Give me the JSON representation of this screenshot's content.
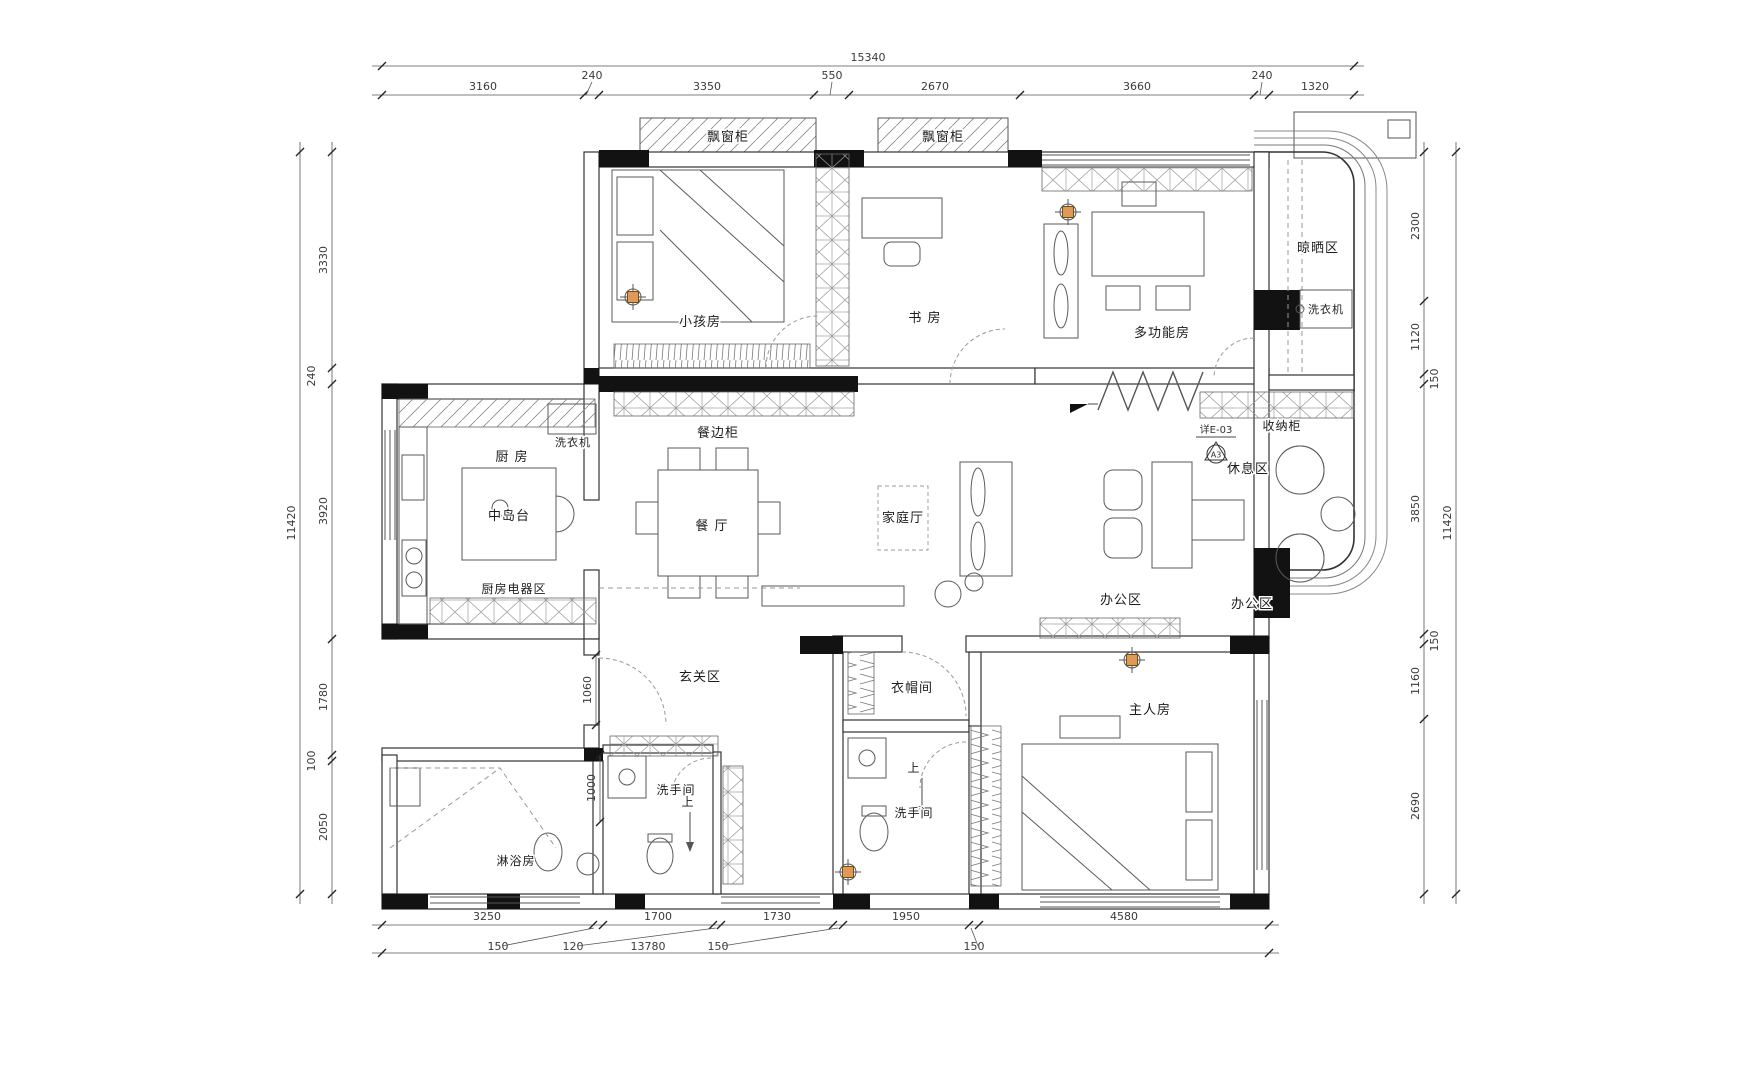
{
  "meta": {
    "drawing_type": "residential floor plan"
  },
  "rooms": {
    "bay_cabinet_1": "飘窗柜",
    "bay_cabinet_2": "飘窗柜",
    "kids_room": "小孩房",
    "study": "书 房",
    "multi_room": "多功能房",
    "drying_area": "晾晒区",
    "washer_balcony": "洗衣机",
    "storage_cabinet": "收纳柜",
    "rest_area": "休息区",
    "office_area_1": "办公区",
    "office_area_2": "办公区",
    "kitchen": "厨 房",
    "washer_kitchen": "洗衣机",
    "sideboard": "餐边柜",
    "island": "中岛台",
    "dining": "餐 厅",
    "family_hall": "家庭厅",
    "appliance_area": "厨房电器区",
    "entry": "玄关区",
    "cloakroom": "衣帽间",
    "master_room": "主人房",
    "bath_guest": "洗手间",
    "bath_master": "洗手间",
    "shower_room": "淋浴房",
    "up_1": "上",
    "up_2": "上"
  },
  "annotations": {
    "detail_ref": "详E-03",
    "detail_bubble": "A3"
  },
  "dimensions": {
    "top": {
      "total": "15340",
      "segments": [
        "3160",
        "240",
        "3350",
        "550",
        "2670",
        "3660",
        "240",
        "1320"
      ]
    },
    "bottom": {
      "total": "13780",
      "segments": [
        "3250",
        "150",
        "1700",
        "120",
        "1730",
        "150",
        "1950",
        "150",
        "4580"
      ]
    },
    "left": {
      "total": "11420",
      "segments": [
        "3330",
        "240",
        "3920",
        "1780",
        "100",
        "2050"
      ]
    },
    "right": {
      "total": "11420",
      "segments": [
        "2300",
        "1120",
        "150",
        "3850",
        "150",
        "1160",
        "2690"
      ]
    },
    "interior": {
      "entry_depth": "1060",
      "bath_width": "1000"
    }
  },
  "colors": {
    "wall": "#121212",
    "line": "#4a4a4a",
    "dim_text": "#3a3a3a",
    "downlight_accent": "#dd9b57",
    "hatch": "#8a8a8a"
  }
}
